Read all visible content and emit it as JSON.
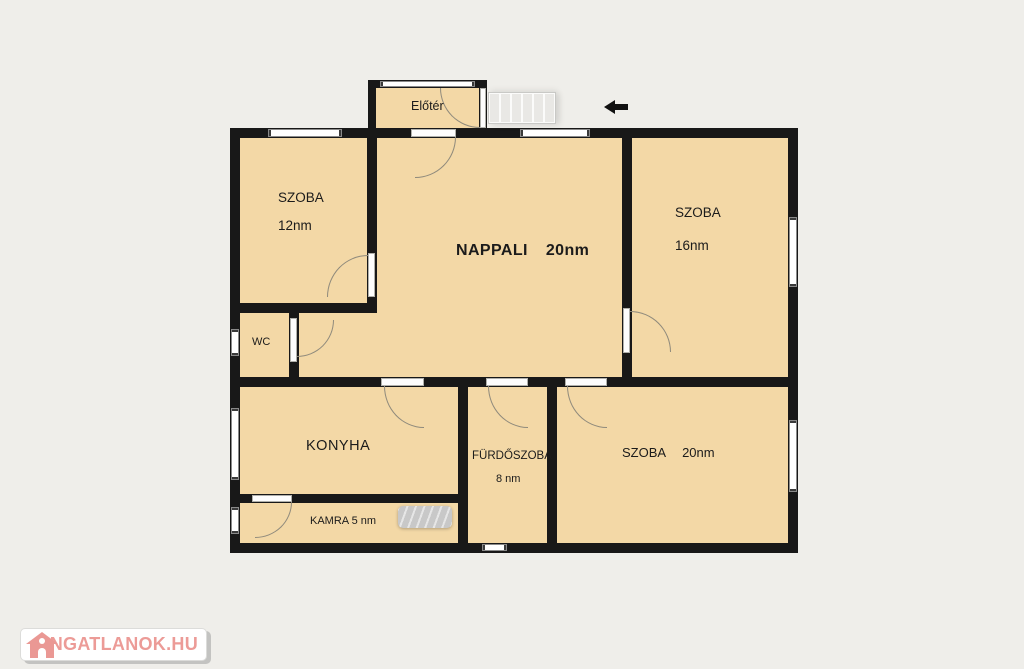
{
  "plan": {
    "rooms": {
      "eloter": {
        "label": "Előtér"
      },
      "szoba12": {
        "label": "SZOBA",
        "area": "12nm"
      },
      "nappali": {
        "label": "NAPPALI",
        "area": "20nm"
      },
      "szoba16": {
        "label": "SZOBA",
        "area": "16nm"
      },
      "wc": {
        "label": "WC"
      },
      "konyha": {
        "label": "KONYHA"
      },
      "furdoszoba": {
        "label": "FÜRDŐSZOBA",
        "area": "8 nm"
      },
      "szoba20": {
        "label": "SZOBA",
        "area": "20nm"
      },
      "kamra": {
        "label": "KAMRA 5 nm"
      }
    },
    "features": {
      "stairs_steps": 6,
      "entrance_arrow_direction": "left"
    },
    "colors": {
      "background": "#efeeea",
      "room_fill": "#f3d8a6",
      "wall": "#181818",
      "window": "#ffffff",
      "door_arc": "#8f8a7c",
      "logo_text": "#ec9b97",
      "logo_house": "#ea9894"
    }
  },
  "watermark": {
    "text": "INGATLANOK.HU"
  }
}
